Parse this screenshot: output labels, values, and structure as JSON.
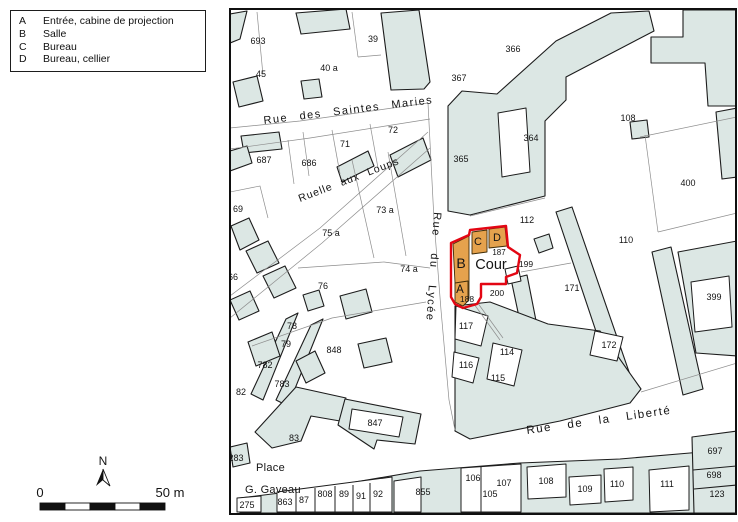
{
  "legend": {
    "items": [
      {
        "key": "A",
        "label": "Entrée, cabine de projection"
      },
      {
        "key": "B",
        "label": "Salle"
      },
      {
        "key": "C",
        "label": "Bureau"
      },
      {
        "key": "D",
        "label": "Bureau, cellier"
      }
    ]
  },
  "north_label": "N",
  "scale_bar": {
    "start_label": "0",
    "end_label": "50 m"
  },
  "map": {
    "colors": {
      "building_fill": "#dce7e4",
      "highlight_fill": "#e5a24d",
      "highlight_outline": "#e30613"
    },
    "street_labels": [
      {
        "t": "Rue des Saintes Maries",
        "x": 264,
        "y": 124,
        "r": -7,
        "ws": 7,
        "ls": 1.5,
        "s": 11
      },
      {
        "t": "Ruelle aux Loups",
        "x": 300,
        "y": 202,
        "r": -21,
        "ws": 5,
        "ls": 1,
        "s": 10.5
      },
      {
        "t": "Rue du Lycée",
        "x": 434,
        "y": 212,
        "r": 94,
        "ws": 12,
        "ls": 1.5,
        "s": 11
      },
      {
        "t": "Rue de la Liberté",
        "x": 527,
        "y": 434,
        "r": -8,
        "ws": 11,
        "ls": 1.5,
        "s": 11.5
      },
      {
        "t": "Place",
        "x": 256,
        "y": 471,
        "r": 0,
        "ws": 0,
        "ls": 0.3,
        "s": 11
      },
      {
        "t": "G. Gaveau",
        "x": 245,
        "y": 493,
        "r": 0,
        "ws": 0,
        "ls": 0.3,
        "s": 11
      }
    ],
    "room_labels": [
      {
        "t": "A",
        "x": 460,
        "y": 293,
        "s": 11.5
      },
      {
        "t": "B",
        "x": 461,
        "y": 268,
        "s": 14
      },
      {
        "t": "C",
        "x": 478,
        "y": 245,
        "s": 11
      },
      {
        "t": "D",
        "x": 497,
        "y": 241,
        "s": 11
      },
      {
        "t": "Cour",
        "x": 491,
        "y": 269,
        "s": 14.5
      }
    ],
    "small_labels": [
      {
        "t": "187",
        "x": 499,
        "y": 255,
        "s": 8
      },
      {
        "t": "199",
        "x": 526,
        "y": 267,
        "s": 8.5
      },
      {
        "t": "188",
        "x": 467,
        "y": 302,
        "s": 8.5
      },
      {
        "t": "200",
        "x": 497,
        "y": 296,
        "s": 8.5
      }
    ],
    "parcel_labels": [
      {
        "t": "693",
        "x": 258,
        "y": 44
      },
      {
        "t": "39",
        "x": 373,
        "y": 42
      },
      {
        "t": "366",
        "x": 513,
        "y": 52
      },
      {
        "t": "45",
        "x": 261,
        "y": 77
      },
      {
        "t": "40 a",
        "x": 329,
        "y": 71
      },
      {
        "t": "367",
        "x": 459,
        "y": 81
      },
      {
        "t": "364",
        "x": 531,
        "y": 141
      },
      {
        "t": "108",
        "x": 628,
        "y": 121
      },
      {
        "t": "687",
        "x": 264,
        "y": 163
      },
      {
        "t": "686",
        "x": 309,
        "y": 166
      },
      {
        "t": "71",
        "x": 345,
        "y": 147
      },
      {
        "t": "72",
        "x": 393,
        "y": 133
      },
      {
        "t": "365",
        "x": 461,
        "y": 162
      },
      {
        "t": "400",
        "x": 688,
        "y": 186
      },
      {
        "t": "69",
        "x": 238,
        "y": 212
      },
      {
        "t": "73 a",
        "x": 385,
        "y": 213
      },
      {
        "t": "112",
        "x": 527,
        "y": 223
      },
      {
        "t": "110",
        "x": 626,
        "y": 243
      },
      {
        "t": "75 a",
        "x": 331,
        "y": 236
      },
      {
        "t": "74 a",
        "x": 409,
        "y": 272
      },
      {
        "t": "76",
        "x": 323,
        "y": 289
      },
      {
        "t": "171",
        "x": 572,
        "y": 291
      },
      {
        "t": "399",
        "x": 714,
        "y": 300
      },
      {
        "t": "66",
        "x": 233,
        "y": 280
      },
      {
        "t": "117",
        "x": 466,
        "y": 329
      },
      {
        "t": "78",
        "x": 292,
        "y": 329
      },
      {
        "t": "79",
        "x": 286,
        "y": 347
      },
      {
        "t": "848",
        "x": 334,
        "y": 353
      },
      {
        "t": "114",
        "x": 507,
        "y": 355
      },
      {
        "t": "782",
        "x": 265,
        "y": 368
      },
      {
        "t": "116",
        "x": 466,
        "y": 368
      },
      {
        "t": "115",
        "x": 498,
        "y": 381
      },
      {
        "t": "783",
        "x": 282,
        "y": 387
      },
      {
        "t": "172",
        "x": 609,
        "y": 348
      },
      {
        "t": "82",
        "x": 241,
        "y": 395
      },
      {
        "t": "847",
        "x": 375,
        "y": 426
      },
      {
        "t": "83",
        "x": 294,
        "y": 441
      },
      {
        "t": "283",
        "x": 236,
        "y": 461
      },
      {
        "t": "697",
        "x": 715,
        "y": 454
      },
      {
        "t": "698",
        "x": 714,
        "y": 478
      },
      {
        "t": "123",
        "x": 717,
        "y": 497
      },
      {
        "t": "863",
        "x": 285,
        "y": 505
      },
      {
        "t": "87",
        "x": 304,
        "y": 503
      },
      {
        "t": "808",
        "x": 325,
        "y": 497
      },
      {
        "t": "89",
        "x": 344,
        "y": 497
      },
      {
        "t": "91",
        "x": 361,
        "y": 499
      },
      {
        "t": "92",
        "x": 378,
        "y": 497
      },
      {
        "t": "855",
        "x": 423,
        "y": 495
      },
      {
        "t": "106",
        "x": 473,
        "y": 481
      },
      {
        "t": "107",
        "x": 504,
        "y": 486
      },
      {
        "t": "105",
        "x": 490,
        "y": 497
      },
      {
        "t": "108",
        "x": 546,
        "y": 484
      },
      {
        "t": "109",
        "x": 585,
        "y": 492
      },
      {
        "t": "110",
        "x": 617,
        "y": 487
      },
      {
        "t": "111",
        "x": 667,
        "y": 487
      },
      {
        "t": "275",
        "x": 247,
        "y": 508
      }
    ]
  }
}
